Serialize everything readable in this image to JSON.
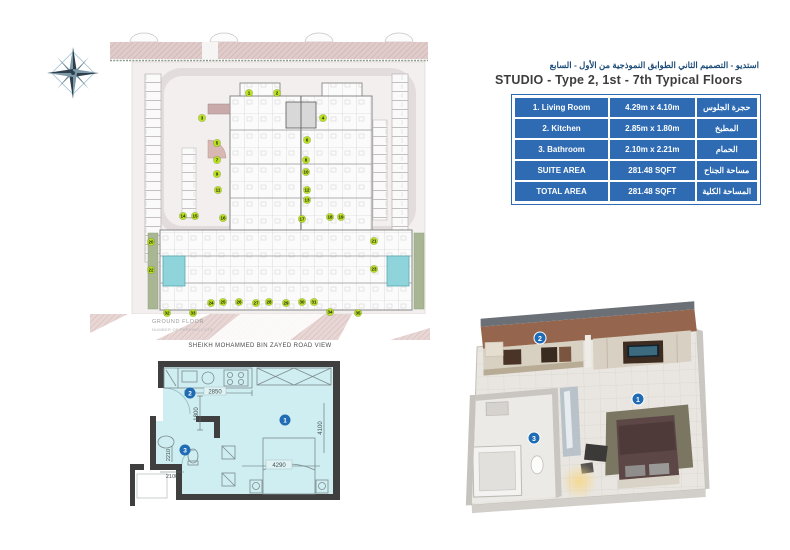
{
  "info_panel": {
    "title_ar": "استديو - التصميم الثاني الطوابق النموذجية من الأول - السابع",
    "title_en": "STUDIO - Type 2, 1st - 7th Typical Floors",
    "accent_color": "#2e6bb2",
    "rows": [
      {
        "name": "1. Living Room",
        "size": "4.29m x 4.10m",
        "name_ar": "حجرة الجلوس"
      },
      {
        "name": "2. Kitchen",
        "size": "2.85m x 1.80m",
        "name_ar": "المطبخ"
      },
      {
        "name": "3. Bathroom",
        "size": "2.10m x 2.21m",
        "name_ar": "الحمام"
      },
      {
        "name": "SUITE AREA",
        "size": "281.48 SQFT",
        "name_ar": "مساحة الجناح"
      },
      {
        "name": "TOTAL AREA",
        "size": "281.48 SQFT",
        "name_ar": "المساحة الكلية"
      }
    ]
  },
  "site_plan": {
    "floor_label": "GROUND FLOOR",
    "floor_sublabel": "NUMBER OF PARKING LOTS",
    "road_label": "SHEIKH MOHAMMED BIN ZAYED ROAD VIEW",
    "marker_color": "#b9e021",
    "markers": [
      {
        "x": 159,
        "y": 65,
        "label": "1"
      },
      {
        "x": 187,
        "y": 65,
        "label": "2"
      },
      {
        "x": 112,
        "y": 90,
        "label": "3"
      },
      {
        "x": 233,
        "y": 90,
        "label": "4"
      },
      {
        "x": 127,
        "y": 115,
        "label": "5"
      },
      {
        "x": 217,
        "y": 112,
        "label": "6"
      },
      {
        "x": 127,
        "y": 132,
        "label": "7"
      },
      {
        "x": 216,
        "y": 132,
        "label": "8"
      },
      {
        "x": 127,
        "y": 146,
        "label": "9"
      },
      {
        "x": 216,
        "y": 144,
        "label": "10"
      },
      {
        "x": 128,
        "y": 162,
        "label": "11"
      },
      {
        "x": 217,
        "y": 162,
        "label": "12"
      },
      {
        "x": 217,
        "y": 172,
        "label": "13"
      },
      {
        "x": 93,
        "y": 188,
        "label": "14"
      },
      {
        "x": 105,
        "y": 188,
        "label": "15"
      },
      {
        "x": 133,
        "y": 190,
        "label": "16"
      },
      {
        "x": 212,
        "y": 191,
        "label": "17"
      },
      {
        "x": 240,
        "y": 189,
        "label": "18"
      },
      {
        "x": 251,
        "y": 189,
        "label": "19"
      },
      {
        "x": 61,
        "y": 214,
        "label": "20"
      },
      {
        "x": 284,
        "y": 213,
        "label": "21"
      },
      {
        "x": 61,
        "y": 242,
        "label": "22"
      },
      {
        "x": 284,
        "y": 241,
        "label": "23"
      },
      {
        "x": 121,
        "y": 275,
        "label": "24"
      },
      {
        "x": 133,
        "y": 274,
        "label": "25"
      },
      {
        "x": 149,
        "y": 274,
        "label": "26"
      },
      {
        "x": 166,
        "y": 275,
        "label": "27"
      },
      {
        "x": 179,
        "y": 274,
        "label": "28"
      },
      {
        "x": 196,
        "y": 275,
        "label": "29"
      },
      {
        "x": 212,
        "y": 274,
        "label": "30"
      },
      {
        "x": 224,
        "y": 274,
        "label": "31"
      },
      {
        "x": 77,
        "y": 285,
        "label": "32"
      },
      {
        "x": 103,
        "y": 285,
        "label": "33"
      },
      {
        "x": 240,
        "y": 284,
        "label": "34"
      },
      {
        "x": 268,
        "y": 285,
        "label": "35"
      }
    ]
  },
  "plan2d": {
    "room_fill": "#cfeef2",
    "marker_color": "#1f6cb5",
    "dims": {
      "kitchen_w": "2850",
      "kitchen_d": "1800",
      "living_w": "4290",
      "living_d": "4100",
      "bath_w": "2100",
      "bath_d": "2210"
    },
    "markers": {
      "living": "1",
      "kitchen": "2",
      "bath": "3"
    }
  },
  "plan3d": {
    "marker_color": "#1f6cb5",
    "markers": {
      "living": "1",
      "kitchen": "2",
      "bath": "3"
    }
  }
}
